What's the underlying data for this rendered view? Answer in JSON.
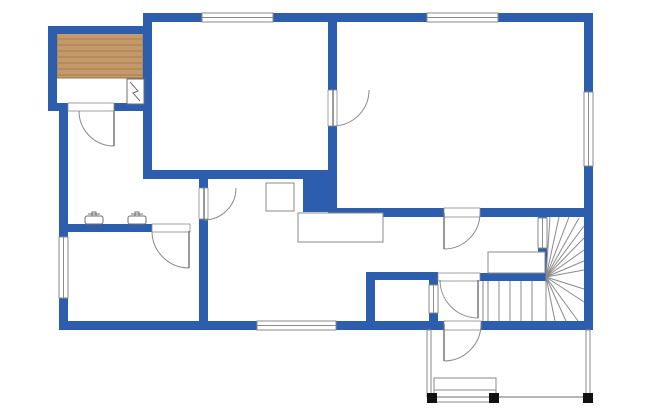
{
  "title": "house-floor-plan",
  "canvas": {
    "width": 650,
    "height": 420,
    "background": "#ffffff"
  },
  "colors": {
    "wall": "#2d5dad",
    "line": "#8a8a8a",
    "line_dark": "#6f6f6f",
    "wood_fill": "#c49a6d",
    "wood_line": "#9a733f",
    "post": "#111111",
    "white": "#ffffff"
  },
  "walls": [
    {
      "name": "exterior-top-wall",
      "rect": [
        143,
        13,
        450,
        9
      ]
    },
    {
      "name": "exterior-right-wall",
      "rect": [
        584,
        13,
        9,
        317
      ]
    },
    {
      "name": "exterior-bottom-wall",
      "rect": [
        59,
        321,
        534,
        9
      ]
    },
    {
      "name": "exterior-left-wall",
      "rect": [
        59,
        103,
        9,
        227
      ]
    },
    {
      "name": "sauna-left-wall",
      "rect": [
        48,
        26,
        9,
        85
      ]
    },
    {
      "name": "sauna-top-wall",
      "rect": [
        48,
        26,
        95,
        8
      ]
    },
    {
      "name": "sauna-bottom-wall",
      "rect": [
        48,
        103,
        104,
        8
      ]
    },
    {
      "name": "bedroom-left-wall",
      "rect": [
        143,
        13,
        9,
        166
      ]
    },
    {
      "name": "bedroom-bottom-wall",
      "rect": [
        143,
        170,
        160,
        9
      ]
    },
    {
      "name": "chimney-block",
      "rect": [
        303,
        170,
        33,
        42
      ]
    },
    {
      "name": "hall-vertical-wall",
      "rect": [
        199,
        175,
        9,
        155
      ]
    },
    {
      "name": "washroom-south-wall",
      "rect": [
        59,
        224,
        93,
        8
      ]
    },
    {
      "name": "livingroom-west-wall",
      "rect": [
        328,
        13,
        9,
        204
      ]
    },
    {
      "name": "livingroom-south-wall",
      "rect": [
        336,
        208,
        257,
        9
      ]
    },
    {
      "name": "small-room-west-wall",
      "rect": [
        366,
        272,
        9,
        58
      ]
    },
    {
      "name": "small-room-north-wall",
      "rect": [
        366,
        272,
        72,
        8
      ]
    },
    {
      "name": "small-room-east-wall",
      "rect": [
        429,
        272,
        9,
        58
      ]
    },
    {
      "name": "vestibule-north-wall",
      "rect": [
        480,
        273,
        67,
        8
      ]
    },
    {
      "name": "stairwell-wall",
      "rect": [
        538,
        216,
        9,
        65
      ]
    }
  ],
  "windows": [
    {
      "name": "bedroom-window",
      "rect": [
        202,
        13,
        71,
        9
      ],
      "orient": "h"
    },
    {
      "name": "livingroom-window",
      "rect": [
        427,
        13,
        71,
        9
      ],
      "orient": "h"
    },
    {
      "name": "right-wall-window",
      "rect": [
        584,
        92,
        9,
        74
      ],
      "orient": "v"
    },
    {
      "name": "left-wall-window",
      "rect": [
        59,
        237,
        9,
        61
      ],
      "orient": "v"
    },
    {
      "name": "kitchen-window",
      "rect": [
        257,
        321,
        79,
        9
      ],
      "orient": "h"
    },
    {
      "name": "stairwell-window",
      "rect": [
        538,
        218,
        9,
        30
      ],
      "orient": "v"
    },
    {
      "name": "small-room-window",
      "rect": [
        429,
        285,
        9,
        28
      ],
      "orient": "v"
    }
  ],
  "openings": [
    {
      "name": "sauna-door-opening",
      "rect": [
        68,
        103,
        46,
        8
      ]
    },
    {
      "name": "washroom-east-opening",
      "rect": [
        199,
        188,
        9,
        31
      ]
    },
    {
      "name": "washroom-south-opening",
      "rect": [
        152,
        224,
        38,
        8
      ]
    },
    {
      "name": "bedroom-door-opening",
      "rect": [
        328,
        90,
        9,
        36
      ]
    },
    {
      "name": "living-entry-opening",
      "rect": [
        444,
        208,
        36,
        9
      ]
    },
    {
      "name": "vestibule-door-opening",
      "rect": [
        438,
        273,
        42,
        8
      ]
    },
    {
      "name": "exterior-door-opening",
      "rect": [
        444,
        321,
        37,
        9
      ]
    }
  ],
  "doors": [
    {
      "name": "sauna-door",
      "cx": 114,
      "cy": 111,
      "r": 35,
      "from": 90,
      "to": 180
    },
    {
      "name": "washroom-east-door",
      "cx": 204,
      "cy": 188,
      "r": 32,
      "from": 90,
      "to": 0
    },
    {
      "name": "washroom-south-door",
      "cx": 189,
      "cy": 231,
      "r": 37,
      "from": 90,
      "to": 180
    },
    {
      "name": "bedroom-door",
      "cx": 333,
      "cy": 90,
      "r": 36,
      "from": 90,
      "to": 0
    },
    {
      "name": "living-entry-door",
      "cx": 444,
      "cy": 213,
      "r": 36,
      "from": 90,
      "to": 0
    },
    {
      "name": "vestibule-door",
      "cx": 478,
      "cy": 280,
      "r": 38,
      "from": 90,
      "to": 180
    },
    {
      "name": "exterior-door",
      "cx": 444,
      "cy": 324,
      "r": 37,
      "from": 90,
      "to": 0
    }
  ],
  "fixtures": [
    {
      "name": "kitchen-stove",
      "rect": [
        266,
        183,
        28,
        28
      ]
    },
    {
      "name": "kitchen-counter",
      "rect": [
        298,
        213,
        85,
        29
      ]
    },
    {
      "name": "stair-landing",
      "rect": [
        488,
        252,
        57,
        21
      ]
    },
    {
      "name": "porch-step-upper",
      "rect": [
        434,
        378,
        62,
        12
      ]
    },
    {
      "name": "porch-step-lower",
      "rect": [
        434,
        390,
        62,
        12
      ]
    }
  ],
  "sauna": {
    "floor_rect": [
      57,
      33,
      86,
      45
    ],
    "stripe_ys": [
      39,
      45,
      51,
      57,
      63,
      69,
      75
    ],
    "stove_rect": [
      127,
      79,
      17,
      25
    ],
    "stove_bolt": [
      [
        130,
        82
      ],
      [
        138,
        91
      ],
      [
        133,
        93
      ],
      [
        140,
        101
      ]
    ]
  },
  "sinks": [
    {
      "name": "washbasin-left",
      "cx": 94,
      "top": 212
    },
    {
      "name": "washbasin-right",
      "cx": 137,
      "top": 212
    }
  ],
  "stairs": {
    "center": [
      546,
      277
    ],
    "fan_ends": [
      [
        550,
        217
      ],
      [
        559,
        217
      ],
      [
        569,
        217
      ],
      [
        579,
        218
      ],
      [
        584,
        226
      ],
      [
        584,
        238
      ],
      [
        584,
        250
      ],
      [
        584,
        261
      ],
      [
        584,
        270
      ],
      [
        584,
        289
      ],
      [
        584,
        302
      ],
      [
        578,
        321
      ],
      [
        566,
        321
      ],
      [
        555,
        321
      ],
      [
        546,
        321
      ]
    ],
    "straight_treads_x": [
      488,
      499,
      510,
      521,
      532
    ],
    "straight_treads_y": [
      281,
      321
    ],
    "run_left_edge": [
      483,
      281,
      483,
      321
    ]
  },
  "porch": {
    "left_rail": [
      427,
      330,
      4,
      67
    ],
    "right_rail": [
      586,
      330,
      4,
      66
    ],
    "bottom_line": [
      427,
      397,
      593,
      397
    ],
    "posts": [
      {
        "name": "porch-post-left",
        "rect": [
          427,
          393,
          10,
          10
        ]
      },
      {
        "name": "porch-post-middle",
        "rect": [
          489,
          393,
          10,
          10
        ]
      },
      {
        "name": "porch-post-right",
        "rect": [
          583,
          393,
          10,
          10
        ]
      }
    ]
  }
}
